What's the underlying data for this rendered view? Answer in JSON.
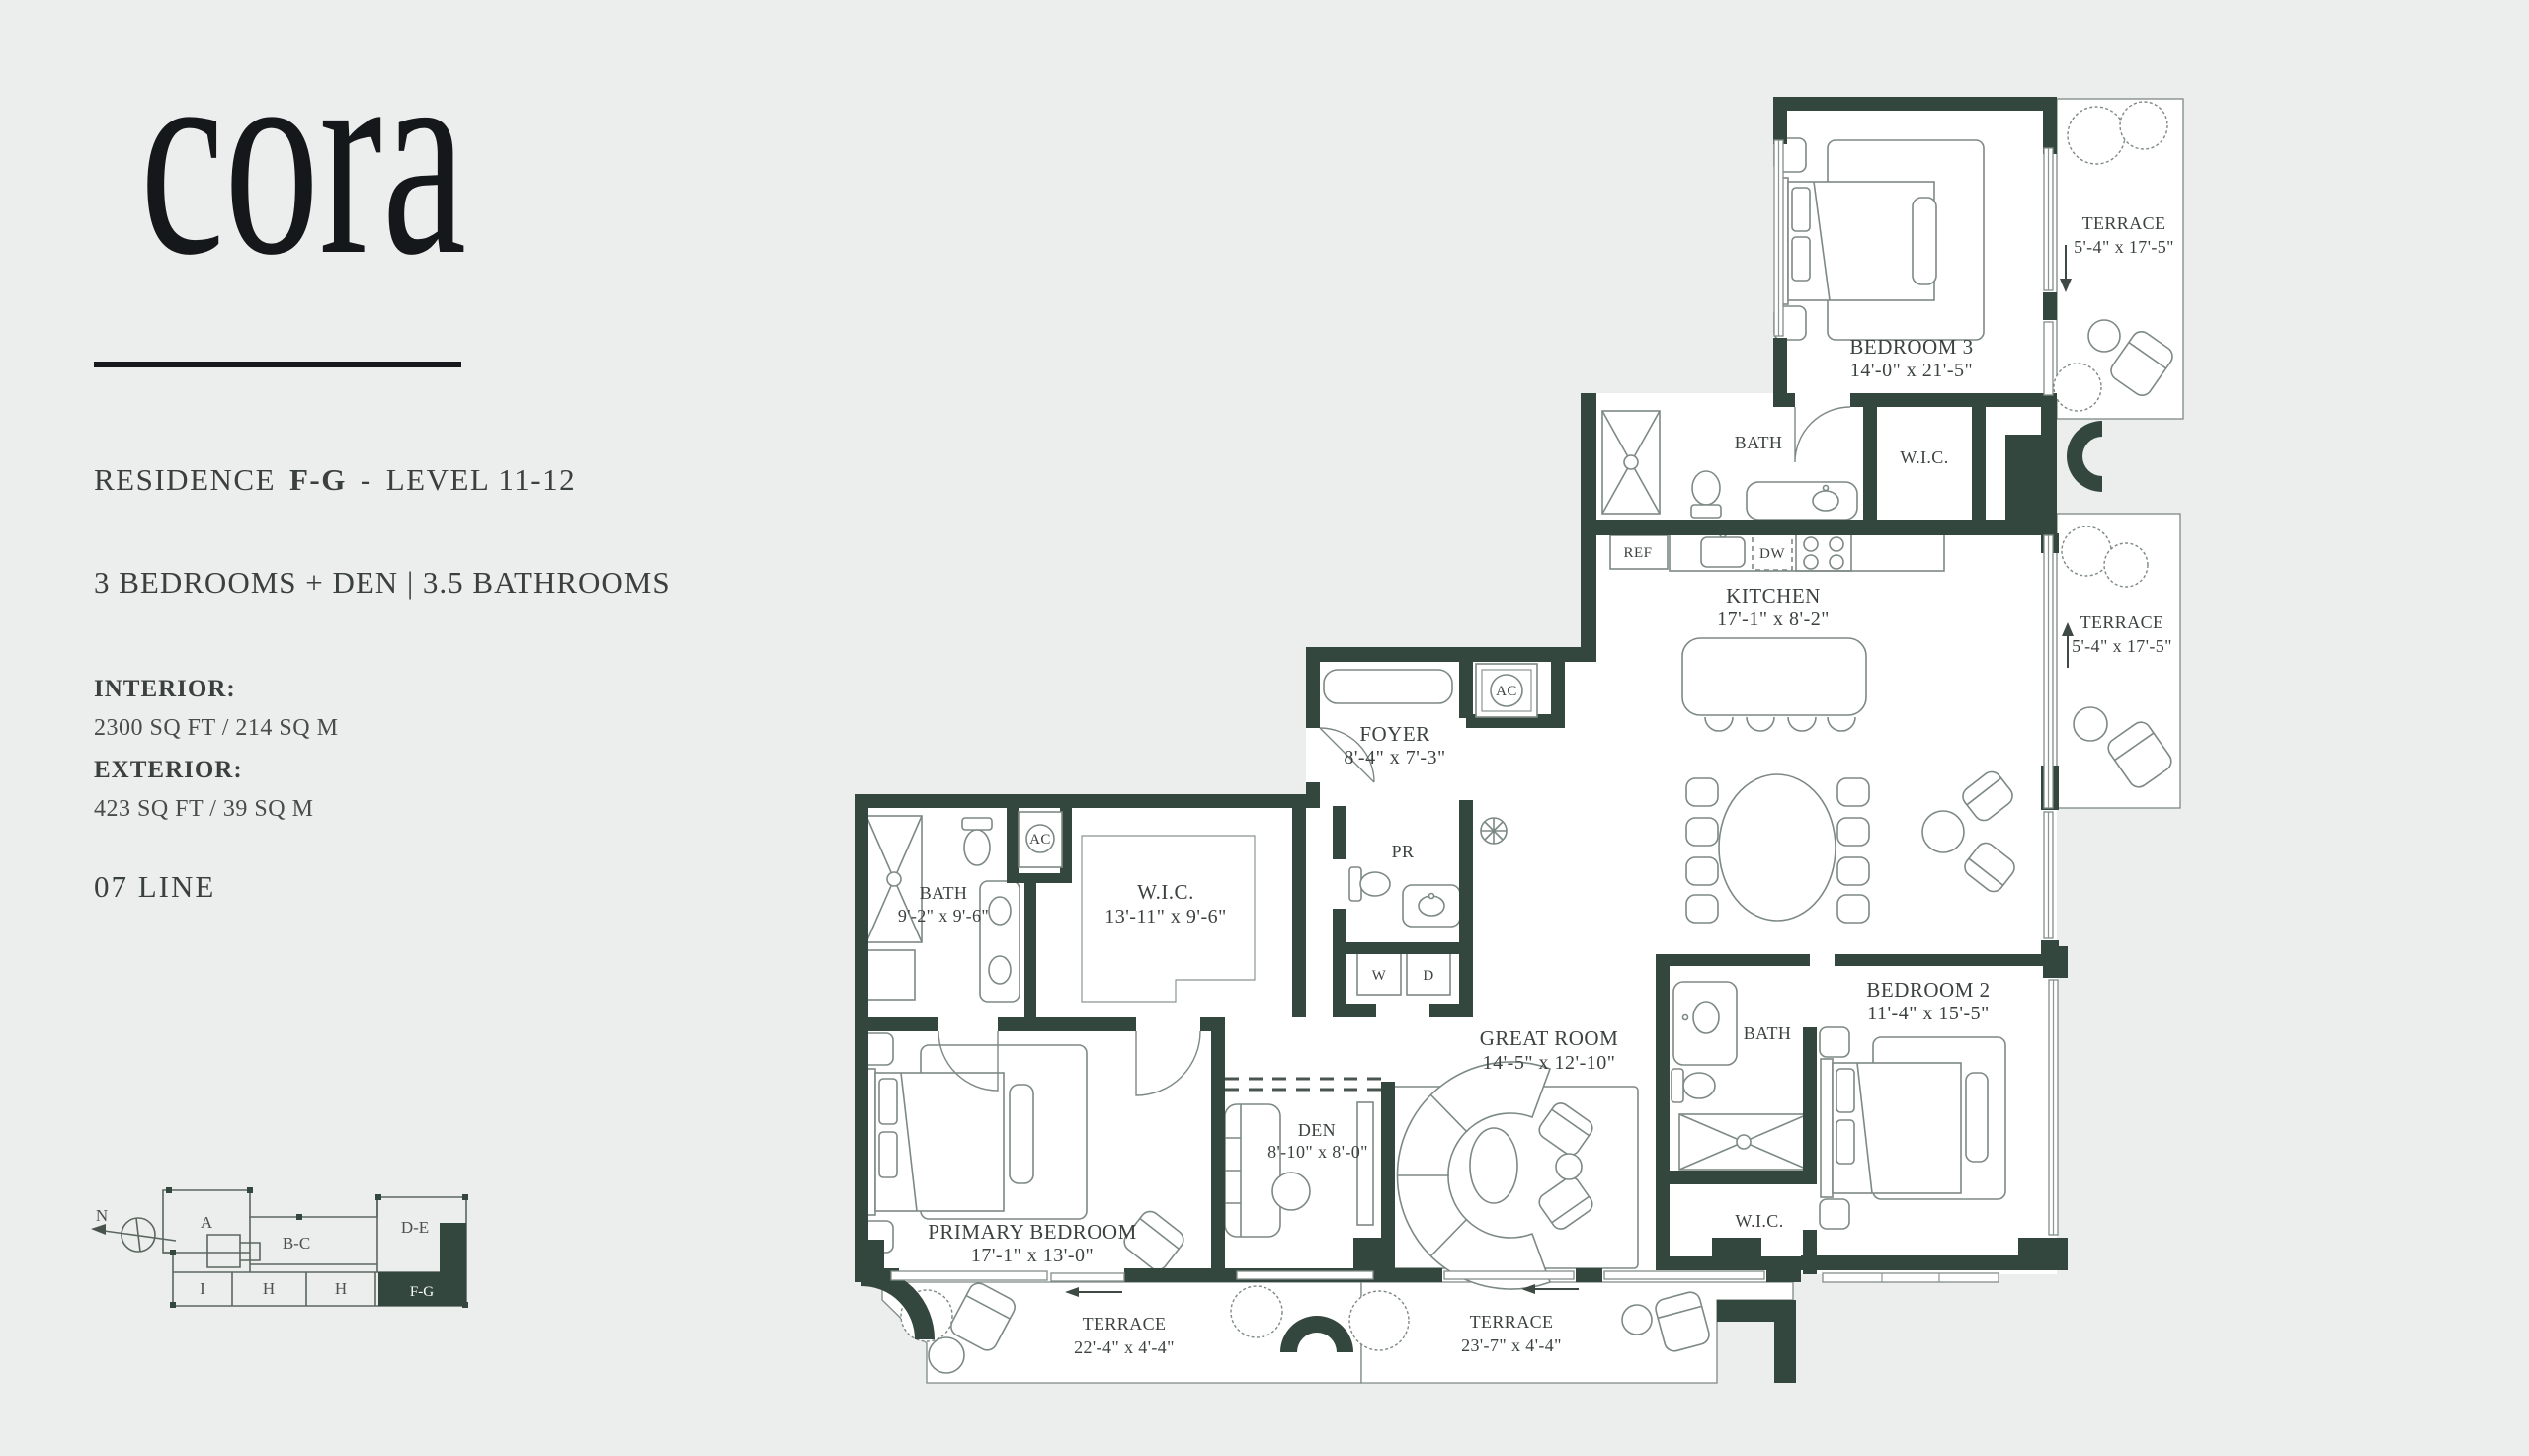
{
  "brand": {
    "logo": "cora"
  },
  "header": {
    "residence_label": "RESIDENCE",
    "unit": "F-G",
    "dash": "-",
    "level": "LEVEL 11-12",
    "config": "3 BEDROOMS + DEN | 3.5 BATHROOMS"
  },
  "stats": {
    "interior_label": "INTERIOR:",
    "interior_value": "2300 SQ FT / 214 SQ M",
    "exterior_label": "EXTERIOR:",
    "exterior_value": "423 SQ FT / 39 SQ M",
    "line_label": "07 LINE"
  },
  "keyplan": {
    "north_label": "N",
    "units": [
      "A",
      "B-C",
      "D-E",
      "I",
      "H",
      "H",
      "F-G"
    ],
    "highlighted_unit": "F-G"
  },
  "rooms": {
    "bedroom3": {
      "name": "BEDROOM 3",
      "dims": "14'-0\" x 21'-5\""
    },
    "terrace_ne": {
      "name": "TERRACE",
      "dims": "5'-4\" x 17'-5\""
    },
    "bath3": {
      "name": "BATH"
    },
    "wic3": {
      "name": "W.I.C."
    },
    "kitchen": {
      "name": "KITCHEN",
      "dims": "17'-1\" x 8'-2\""
    },
    "terrace_e": {
      "name": "TERRACE",
      "dims": "5'-4\" x 17'-5\""
    },
    "foyer": {
      "name": "FOYER",
      "dims": "8'-4\" x 7'-3\""
    },
    "powder_room": {
      "name": "PR"
    },
    "bath_primary": {
      "name": "BATH",
      "dims": "9'-2\" x 9'-6\""
    },
    "wic_primary": {
      "name": "W.I.C.",
      "dims": "13'-11\" x 9'-6\""
    },
    "great_room": {
      "name": "GREAT ROOM",
      "dims": "14'-5\" x 12'-10\""
    },
    "den": {
      "name": "DEN",
      "dims": "8'-10\" x 8'-0\""
    },
    "primary_bedroom": {
      "name": "PRIMARY BEDROOM",
      "dims": "17'-1\" x 13'-0\""
    },
    "bedroom2": {
      "name": "BEDROOM 2",
      "dims": "11'-4\" x 15'-5\""
    },
    "bath2": {
      "name": "BATH"
    },
    "wic2": {
      "name": "W.I.C."
    },
    "terrace_sw": {
      "name": "TERRACE",
      "dims": "22'-4\" x 4'-4\""
    },
    "terrace_s": {
      "name": "TERRACE",
      "dims": "23'-7\" x 4'-4\""
    }
  },
  "appliances": {
    "refrigerator": "REF",
    "dishwasher": "DW",
    "ac": "AC",
    "washer": "W",
    "dryer": "D"
  },
  "colors": {
    "wall": "#33473f",
    "page_background": "#eceeed",
    "floor": "#ffffff",
    "furniture_line": "#7d8984",
    "text": "#3b423f"
  }
}
